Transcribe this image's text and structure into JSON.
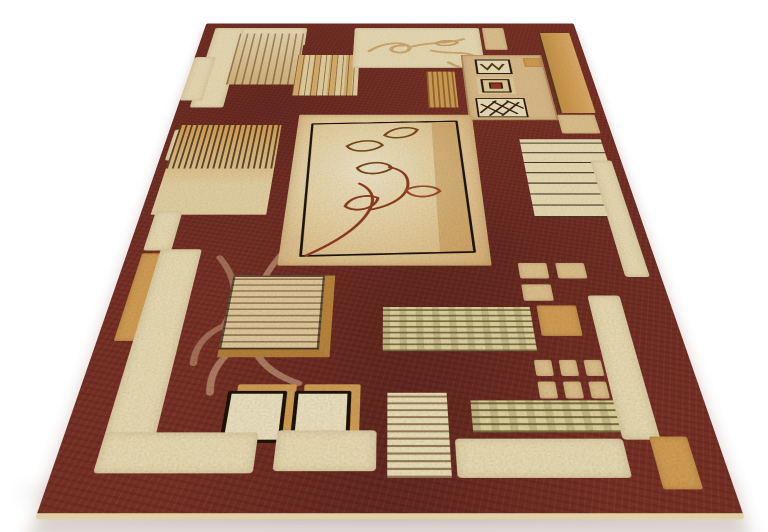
{
  "scene": {
    "description": "Product photograph of a rectangular area rug lying flat, viewed in perspective against a plain white studio background with a soft shadow under its lower edge.",
    "subject": "brown-and-beige patchwork area rug",
    "background_color": "#FFFFFF"
  },
  "palette": {
    "field": "#7B3126",
    "field_dark": "#5E2018",
    "cream": "#EDDFB6",
    "cream_bright": "#F2E9CE",
    "beige": "#E2C48F",
    "gold": "#D6A155",
    "gold_deep": "#BE883C",
    "outline_dark": "#241608",
    "leaf_red": "#8F3C1E",
    "leaf_brown": "#7A4A1A",
    "olive_stripe": "#6E6B38",
    "tan_motif": "#D9B87E"
  },
  "rug": {
    "style": "modern geometric patchwork with leaf-vine motifs",
    "elements": [
      {
        "name": "top-left-bracket-horizontal",
        "type": "cream",
        "x": 14,
        "y": 14,
        "w": 120,
        "h": 50
      },
      {
        "name": "top-left-bracket-vertical",
        "type": "cream",
        "x": 14,
        "y": 14,
        "w": 38,
        "h": 206
      },
      {
        "name": "woodgrain-square",
        "type": "woodgrain",
        "x": 48,
        "y": 30,
        "w": 84,
        "h": 136
      },
      {
        "name": "stripe-block-top-left",
        "type": "vstripes",
        "x": 128,
        "y": 90,
        "w": 76,
        "h": 102
      },
      {
        "name": "top-center-cream-panel",
        "type": "cream",
        "x": 196,
        "y": 14,
        "w": 162,
        "h": 110,
        "svg": "topcurves"
      },
      {
        "name": "top-tile",
        "type": "beige",
        "x": 362,
        "y": 14,
        "w": 28,
        "h": 62
      },
      {
        "name": "gold-stripe-tile",
        "type": "goldstripes",
        "x": 286,
        "y": 134,
        "w": 34,
        "h": 86
      },
      {
        "name": "motif-square",
        "type": "motif",
        "x": 330,
        "y": 90,
        "w": 100,
        "h": 158
      },
      {
        "name": "motif-zigzag-tile",
        "type": "svgtile",
        "x": 346,
        "y": 102,
        "w": 44,
        "h": 38,
        "svg": "zigzag"
      },
      {
        "name": "motif-red-center-tile",
        "type": "svgtile",
        "x": 344,
        "y": 148,
        "w": 46,
        "h": 42,
        "svg": "redcenter"
      },
      {
        "name": "motif-crosshatch-tile",
        "type": "svgtile",
        "x": 340,
        "y": 198,
        "w": 58,
        "h": 44,
        "svg": "crosshatch"
      },
      {
        "name": "right-gold-bar",
        "type": "goldbar",
        "x": 434,
        "y": 28,
        "w": 38,
        "h": 204
      },
      {
        "name": "right-gold-bar-foot",
        "type": "beige",
        "x": 430,
        "y": 236,
        "w": 42,
        "h": 40
      },
      {
        "name": "right-top-tile",
        "type": "gold",
        "x": 406,
        "y": 98,
        "w": 22,
        "h": 24
      },
      {
        "name": "left-edge-tile-a",
        "type": "cream",
        "x": 0,
        "y": 96,
        "w": 26,
        "h": 108
      },
      {
        "name": "left-edge-tile-b",
        "type": "cream",
        "x": 6,
        "y": 268,
        "w": 30,
        "h": 62
      },
      {
        "name": "left-fringe-block",
        "type": "fringe",
        "x": 10,
        "y": 258,
        "w": 112,
        "h": 168
      },
      {
        "name": "central-leaf-panel",
        "type": "panel",
        "x": 140,
        "y": 236,
        "w": 194,
        "h": 268,
        "svg": "panelvine"
      },
      {
        "name": "right-stripe-block",
        "type": "hstripes",
        "x": 382,
        "y": 288,
        "w": 88,
        "h": 142
      },
      {
        "name": "right-vertical-bar",
        "type": "cream",
        "x": 452,
        "y": 330,
        "w": 22,
        "h": 190
      },
      {
        "name": "left-lower-tile",
        "type": "cream",
        "x": 14,
        "y": 420,
        "w": 26,
        "h": 62
      },
      {
        "name": "left-gold-bar",
        "type": "gold",
        "x": 14,
        "y": 486,
        "w": 26,
        "h": 116
      },
      {
        "name": "left-cream-bar",
        "type": "cream",
        "x": 30,
        "y": 480,
        "w": 38,
        "h": 226
      },
      {
        "name": "field-vine-flourish",
        "type": "svgonly",
        "x": 58,
        "y": 452,
        "w": 130,
        "h": 225,
        "svg": "fieldvine"
      },
      {
        "name": "ornate-woodgrain-square",
        "type": "ornate",
        "x": 102,
        "y": 518,
        "w": 82,
        "h": 94
      },
      {
        "name": "right-tile-1",
        "type": "beige",
        "x": 358,
        "y": 500,
        "w": 26,
        "h": 22
      },
      {
        "name": "right-tile-2",
        "type": "beige",
        "x": 392,
        "y": 500,
        "w": 26,
        "h": 22
      },
      {
        "name": "right-tile-3",
        "type": "beige",
        "x": 358,
        "y": 530,
        "w": 26,
        "h": 22
      },
      {
        "name": "right-gold-square",
        "type": "gold",
        "x": 368,
        "y": 558,
        "w": 34,
        "h": 38
      },
      {
        "name": "mid-stripe-band",
        "type": "olivestripes",
        "x": 236,
        "y": 560,
        "w": 126,
        "h": 54
      },
      {
        "name": "small-tile-1",
        "type": "beige",
        "x": 358,
        "y": 624,
        "w": 14,
        "h": 18
      },
      {
        "name": "small-tile-2",
        "type": "beige",
        "x": 378,
        "y": 624,
        "w": 14,
        "h": 18
      },
      {
        "name": "small-tile-3",
        "type": "beige",
        "x": 398,
        "y": 624,
        "w": 14,
        "h": 18
      },
      {
        "name": "small-tile-4",
        "type": "beige",
        "x": 358,
        "y": 648,
        "w": 14,
        "h": 18
      },
      {
        "name": "small-tile-5",
        "type": "beige",
        "x": 378,
        "y": 648,
        "w": 14,
        "h": 18
      },
      {
        "name": "small-tile-6",
        "type": "beige",
        "x": 398,
        "y": 648,
        "w": 14,
        "h": 18
      },
      {
        "name": "lower-stripe-band",
        "type": "olivestripes",
        "x": 304,
        "y": 668,
        "w": 112,
        "h": 32
      },
      {
        "name": "outlined-square-1",
        "type": "outlined",
        "x": 116,
        "y": 658,
        "w": 40,
        "h": 46
      },
      {
        "name": "outlined-square-2",
        "type": "outlined",
        "x": 168,
        "y": 658,
        "w": 38,
        "h": 46
      },
      {
        "name": "bottom-striped-square",
        "type": "finestripes",
        "x": 240,
        "y": 660,
        "w": 46,
        "h": 82
      },
      {
        "name": "right-bottom-bar",
        "type": "cream",
        "x": 414,
        "y": 545,
        "w": 28,
        "h": 162
      },
      {
        "name": "bottom-bar-left",
        "type": "cream",
        "x": 30,
        "y": 700,
        "w": 114,
        "h": 38
      },
      {
        "name": "bottom-bar-mid",
        "type": "cream",
        "x": 158,
        "y": 698,
        "w": 74,
        "h": 38
      },
      {
        "name": "bottom-bar-right",
        "type": "cream",
        "x": 290,
        "y": 706,
        "w": 124,
        "h": 36
      },
      {
        "name": "bottom-right-gold-corner",
        "type": "gold",
        "x": 434,
        "y": 704,
        "w": 28,
        "h": 48
      }
    ]
  }
}
